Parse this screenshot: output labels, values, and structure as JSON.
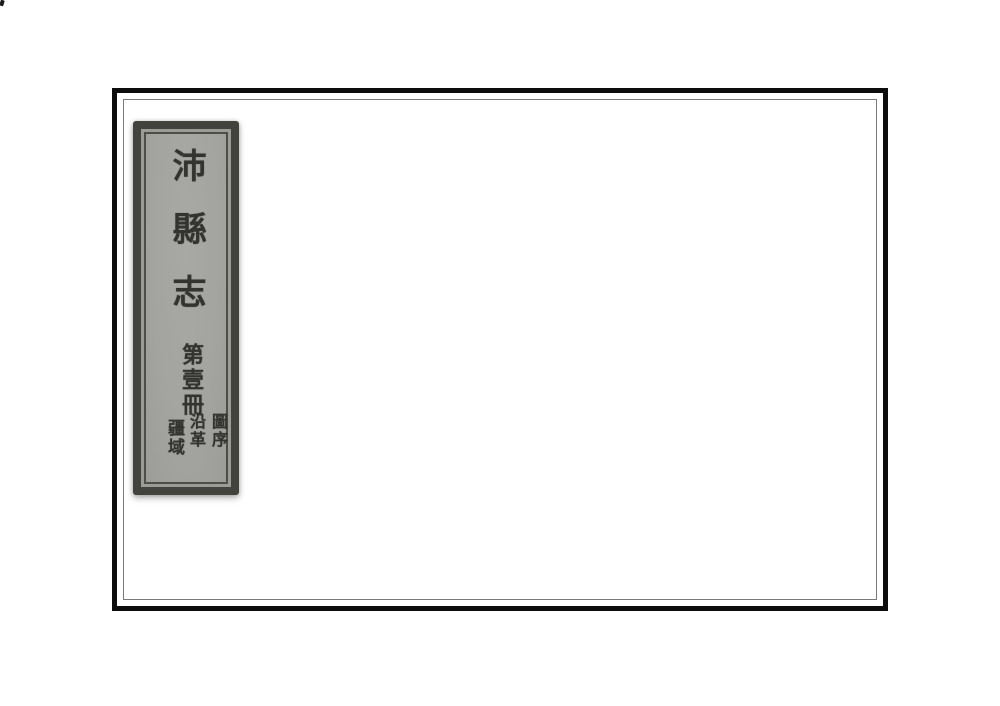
{
  "scan": {
    "background_color": "#ffffff",
    "artifact": "corner-speck"
  },
  "cover": {
    "frame_color": "#0d0d0d",
    "inner_rule_color": "#7a7a7a",
    "paper_color": "#ffffff"
  },
  "spine_label": {
    "title": "沛縣志",
    "volume": "第壹冊",
    "contents": [
      "圖序",
      "沿革",
      "疆域"
    ],
    "background_color": "#a4a4a0",
    "frame_color": "#43433d",
    "text_color": "#33332f"
  }
}
